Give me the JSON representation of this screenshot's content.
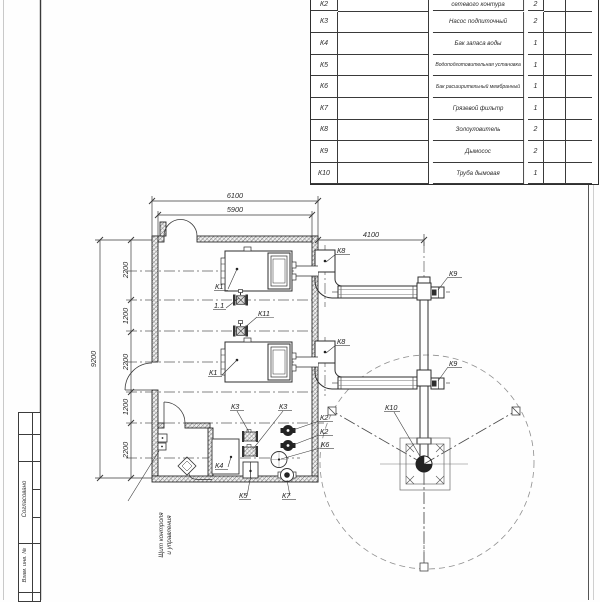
{
  "table": {
    "rows": [
      {
        "pos": "К2",
        "name": "сетевого контура",
        "qty": "2"
      },
      {
        "pos": "К3",
        "name": "Насос подпиточный",
        "qty": "2"
      },
      {
        "pos": "К4",
        "name": "Бак запаса воды",
        "qty": "1"
      },
      {
        "pos": "К5",
        "name": "Водоподготовительная установка",
        "qty": "1"
      },
      {
        "pos": "К6",
        "name": "Бак расширительный мембранный",
        "qty": "1"
      },
      {
        "pos": "К7",
        "name": "Грязевой фильтр",
        "qty": "1"
      },
      {
        "pos": "К8",
        "name": "Золоуловитель",
        "qty": "2"
      },
      {
        "pos": "К9",
        "name": "Дымосос",
        "qty": "2"
      },
      {
        "pos": "К10",
        "name": "Труба дымовая",
        "qty": "1"
      }
    ]
  },
  "stamp": {
    "agreed": "Согласовано",
    "replacement_inv": "Взам. инв. №"
  },
  "dims": {
    "width_outer": "6100",
    "width_inner": "5900",
    "flue_offset": "4100",
    "depth_total": "9200",
    "chain": [
      "2200",
      "1200",
      "2200",
      "1200",
      "2200"
    ]
  },
  "labels": {
    "boiler1": "К1",
    "boiler2": "К1",
    "valve11": "1.1",
    "valve_k11": "К11",
    "pump_k3_1": "К3",
    "pump_k3_2": "К3",
    "pump_k2_1": "К2",
    "pump_k2_2": "К2",
    "tank_k6": "К6",
    "unit_k5": "К5",
    "filter_k7": "К7",
    "tank_k4": "К4",
    "ash_k8_1": "К8",
    "ash_k8_2": "К8",
    "fan_k9_1": "К9",
    "fan_k9_2": "К9",
    "chimney_k10": "К10"
  },
  "note": {
    "line1": "Щит контроля",
    "line2": "и управления"
  },
  "colors": {
    "line": "#333333",
    "thin": "#666666",
    "accent": "#222222"
  }
}
